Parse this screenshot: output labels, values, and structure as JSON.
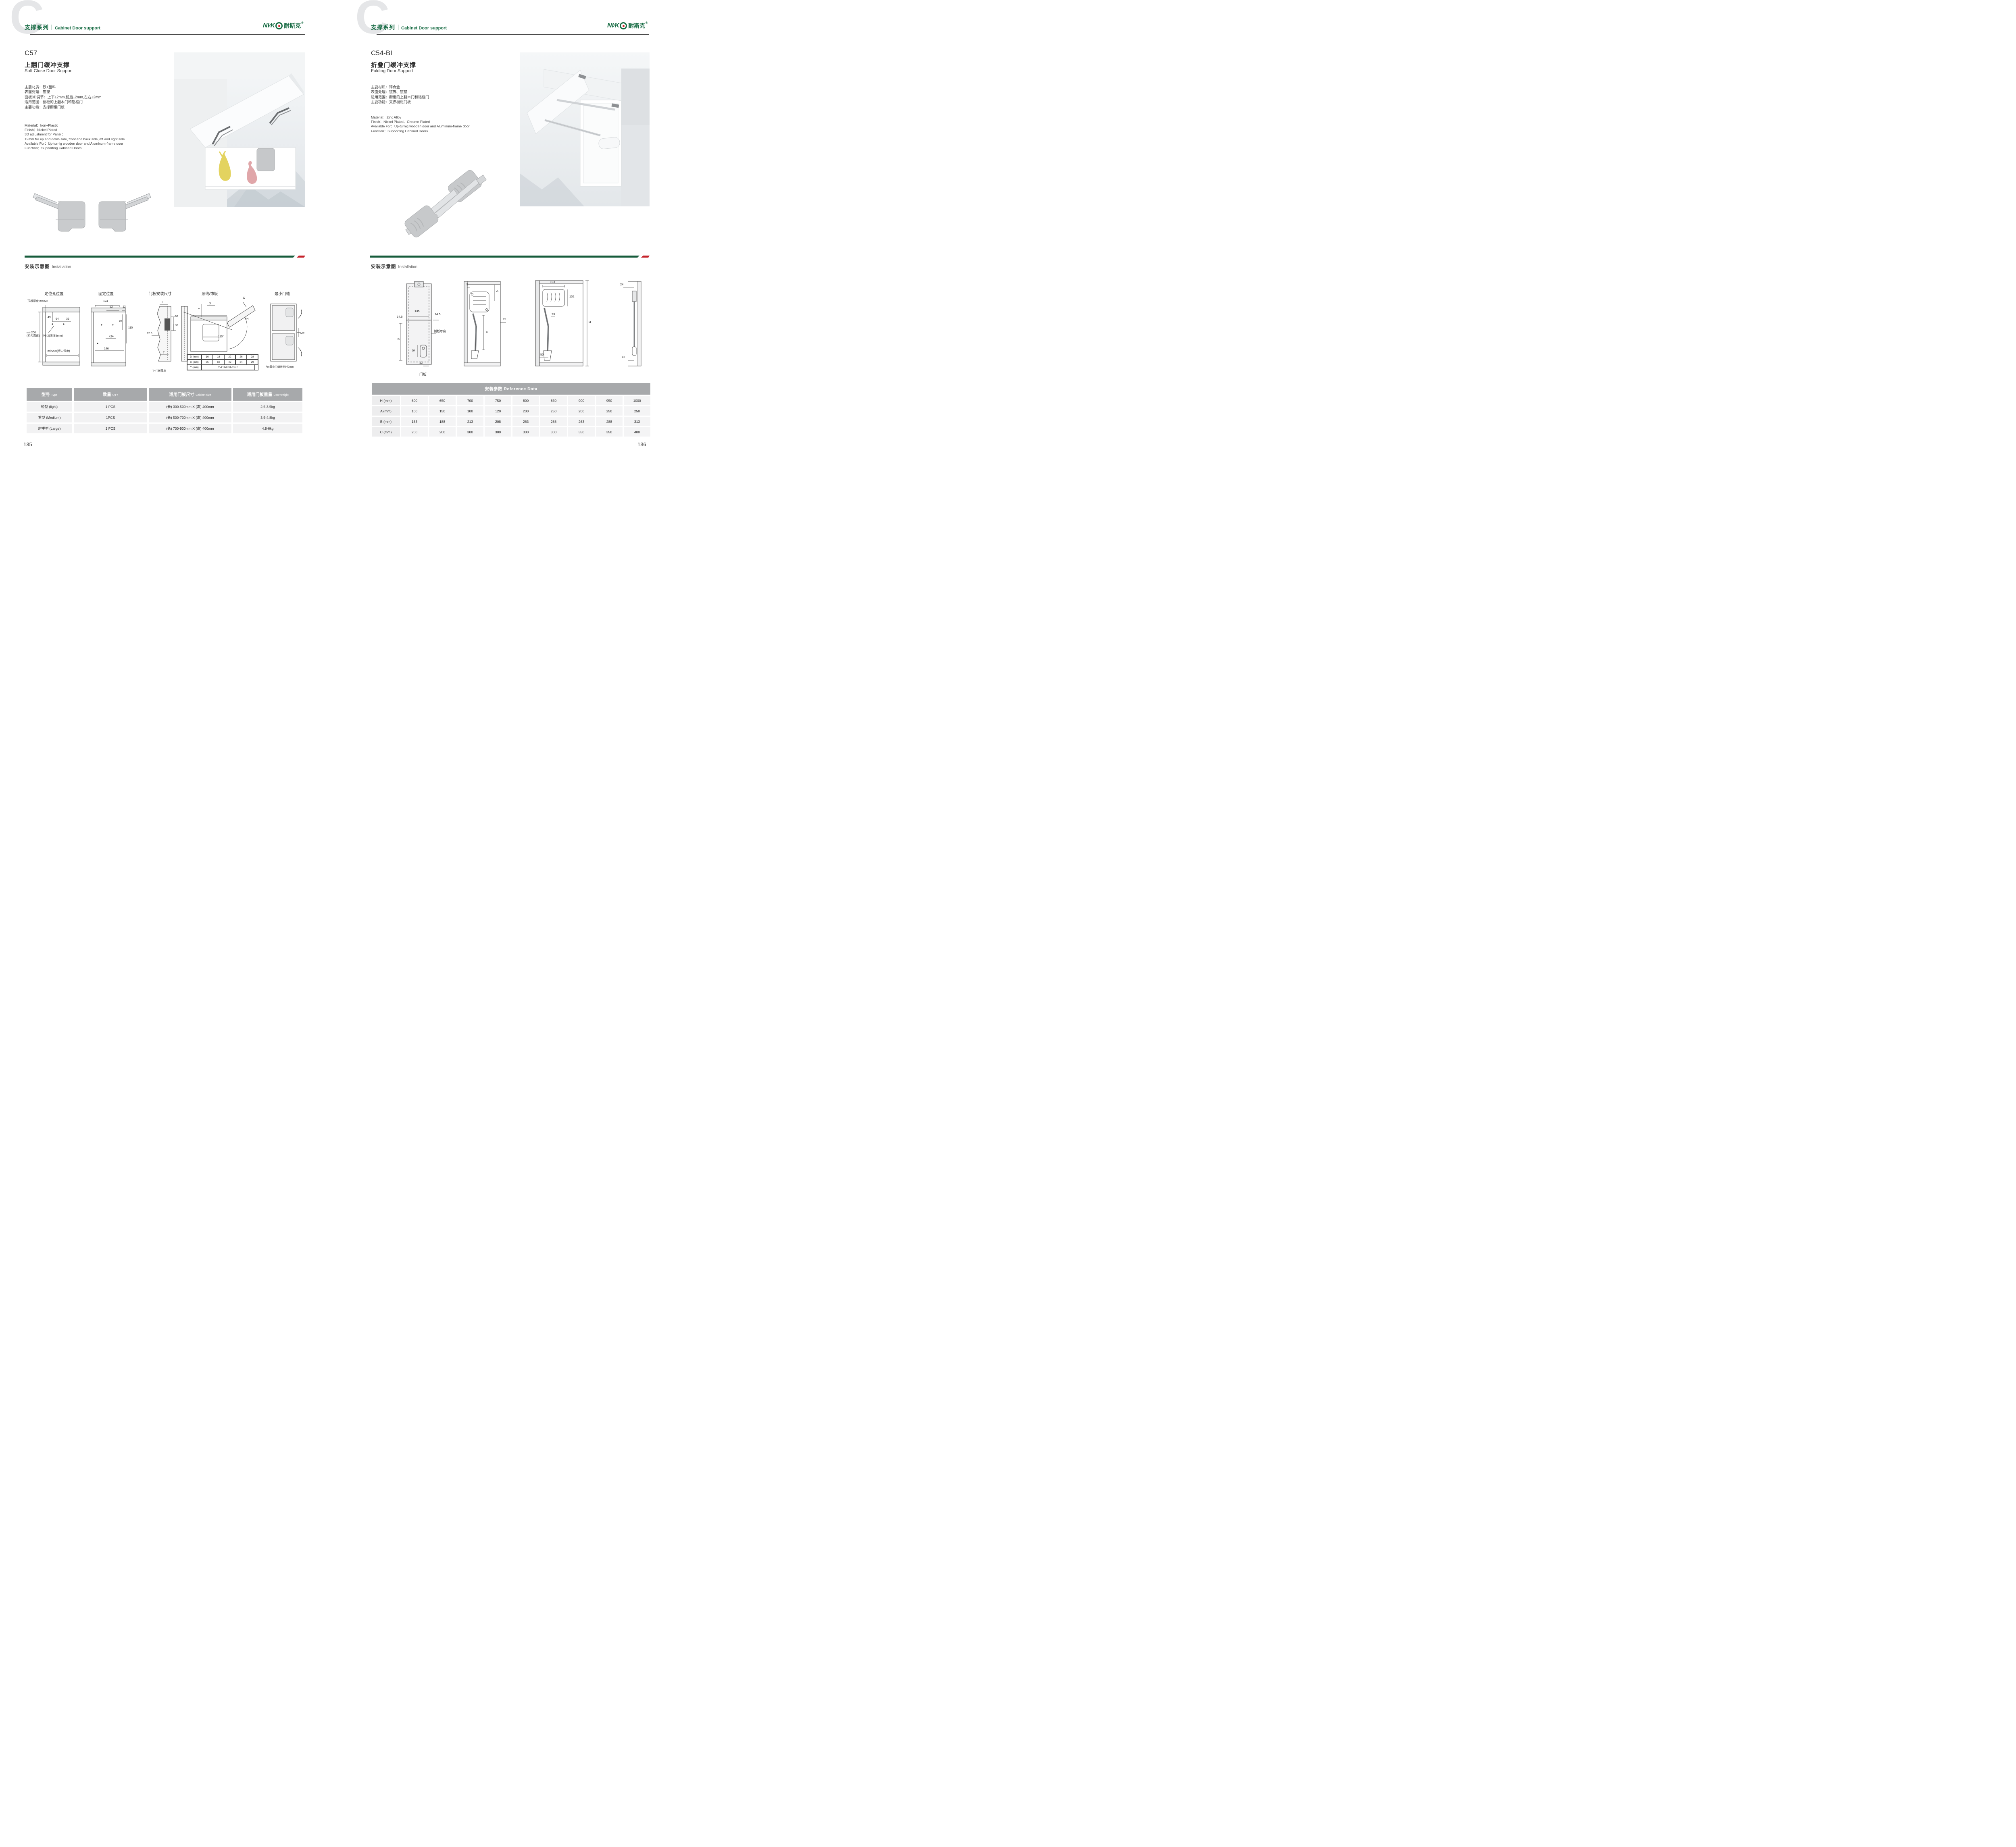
{
  "brand": {
    "latin": "NI∕K",
    "cn": "耐斯克",
    "reg": "®"
  },
  "left_page": {
    "watermark": "C",
    "header": {
      "series_cn": "支撑系列",
      "series_en": "Cabinet Door support"
    },
    "product": {
      "code": "C57",
      "name_cn": "上翻门缓冲支撑",
      "name_en": "Soft Close Door Support",
      "specs_cn": [
        "主要材质：铁+塑料",
        "表面处理：镀镍",
        "面板3D调节：上下±2mm,前后±2mm,左右±2mm",
        "适用范围：橱柜的上翻木门和铝框门",
        "主要功能：支撑橱柜门板"
      ],
      "specs_en": [
        "Material：Iron+Plastic",
        "Finish：Nickel Plated",
        "3D adjustment for Panel：",
        "±2mm for up and down side, front and back side,left and right side",
        "Available For：Up-turnig wooden door and Aluminum-frame door",
        "Function：Supoorting Cabined Doors"
      ]
    },
    "installation": {
      "title_cn": "安装示意图",
      "title_en": "Installation"
    },
    "diagrams": {
      "d1": {
        "title": "定位孔位置",
        "top_note": "顶板厚度 max22",
        "dim49": "49",
        "dim64": "64",
        "dim36": "36",
        "hole_note": "Φ5.2(深度5mm)",
        "min200": "min200",
        "min200_sub": "(柜内高度)",
        "min230": "min230(柜内深度)"
      },
      "d2": {
        "title": "固定位置",
        "dim124": "124",
        "dim52": "52",
        "dim12": "12",
        "dim81": "81",
        "dim115": "115",
        "dim42": "42",
        "dim146": "146"
      },
      "d3": {
        "title": "门板安装尺寸",
        "t_top": "T",
        "dim53": "53",
        "dim32": "32",
        "dim125": "12.5",
        "t_bottom": "T",
        "note": "T=门板厚度"
      },
      "d4": {
        "title": "顶线/饰板",
        "y": "Y",
        "x": "X",
        "d": "D",
        "fh": "FH",
        "angle": "110°",
        "table": {
          "r1": [
            "D (mm)",
            "16",
            "18",
            "22",
            "26",
            "28"
          ],
          "r2": [
            "X (mm)",
            "55",
            "50",
            "42",
            "34",
            "29"
          ],
          "r3_label": "Y (mm)",
          "r3_value": "Y=FHx0.31-15+D"
        }
      },
      "d5": {
        "title": "最小门缝",
        "mf": "MF",
        "note": "Fm最小门缝开启时2mm"
      }
    },
    "table": {
      "headers": [
        {
          "cn": "型号",
          "en": "Type"
        },
        {
          "cn": "数量",
          "en": "QTY"
        },
        {
          "cn": "适用门板尺寸",
          "en": "Cabinet size"
        },
        {
          "cn": "适用门板重量",
          "en": "Door weight"
        }
      ],
      "rows": [
        [
          "轻型 (light)",
          "1 PCS",
          "(长) 300-500mm X (高) 400mm",
          "2.5-3.5kg"
        ],
        [
          "重型 (Medium)",
          "1PCS",
          "(长) 500-700mm X (高) 400mm",
          "3.5-4.8kg"
        ],
        [
          "超重型 (Large)",
          "1 PCS",
          "(长) 700-900mm X (高) 400mm",
          "4.8-6kg"
        ]
      ]
    },
    "page_number": "135"
  },
  "right_page": {
    "watermark": "C",
    "header": {
      "series_cn": "支撑系列",
      "series_en": "Cabinet Door support"
    },
    "product": {
      "code": "C54-BI",
      "name_cn": "折叠门缓冲支撑",
      "name_en": "Folding Door Support",
      "specs_cn": [
        "主要材质：锌合金",
        "表面处理：镀镍、镀铬",
        "适用范围：橱柜的上翻木门和铝框门",
        "主要功能：支撑橱柜门板"
      ],
      "specs_en": [
        "Material：Zinc Alloy",
        "Finish：Nickel Plated、Chrome Plated",
        "Available For：Up-turnig wooden door and Aluminum-frame door",
        "Function：Supoorting Cabined Doors"
      ]
    },
    "installation": {
      "title_cn": "安装示意图",
      "title_en": "Installation"
    },
    "diagrams": {
      "d1": {
        "dim135": "135",
        "dim145a": "14.5",
        "dim145b": "14.5",
        "b": "B",
        "side_note": "侧板厚度",
        "dim54": "54",
        "dim12": "12",
        "caption": "门板"
      },
      "d2": {
        "dim5": "5",
        "a": "A",
        "dim19": "19",
        "c": "C"
      },
      "d3": {
        "dim193": "193",
        "dim102": "102",
        "dim23": "23",
        "h": "H",
        "dim50": "50"
      },
      "d4": {
        "dim24": "24",
        "dim12": "12"
      }
    },
    "ref_table": {
      "title": "安装参数 Reference Data",
      "rows": [
        {
          "label": "H (mm)",
          "values": [
            "600",
            "650",
            "700",
            "750",
            "800",
            "850",
            "900",
            "950",
            "1000"
          ]
        },
        {
          "label": "A (mm)",
          "values": [
            "100",
            "150",
            "100",
            "120",
            "200",
            "250",
            "200",
            "250",
            "250"
          ]
        },
        {
          "label": "B (mm)",
          "values": [
            "163",
            "188",
            "213",
            "208",
            "263",
            "288",
            "263",
            "288",
            "313"
          ]
        },
        {
          "label": "C (mm)",
          "values": [
            "200",
            "200",
            "300",
            "300",
            "300",
            "300",
            "350",
            "350",
            "400"
          ]
        }
      ]
    },
    "page_number": "136"
  }
}
